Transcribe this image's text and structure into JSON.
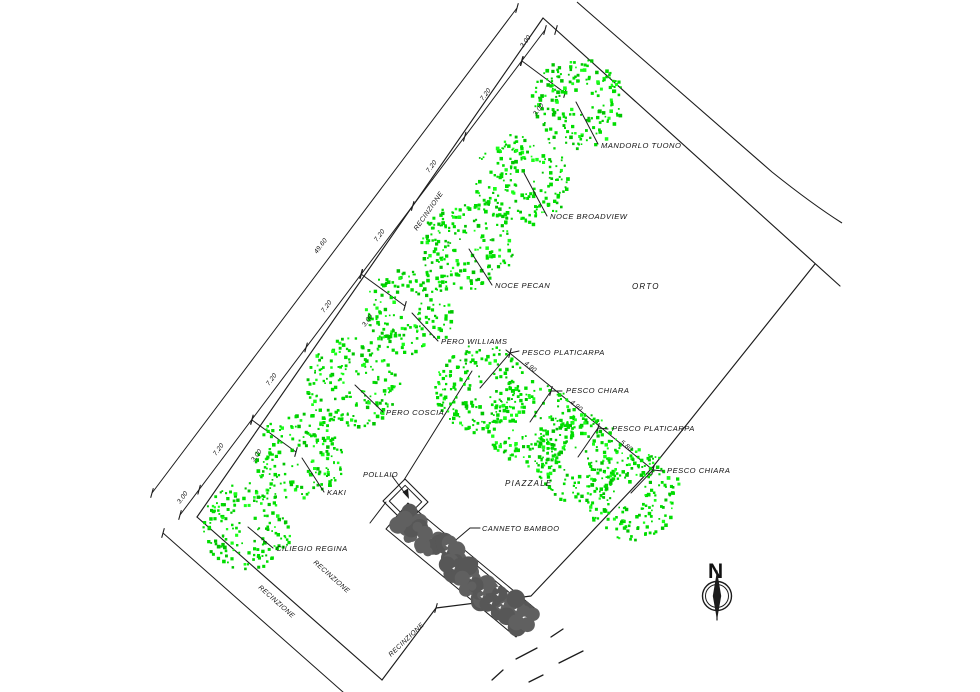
{
  "colors": {
    "line": "#1c1c1c",
    "tree_green": "#00dd00",
    "tree_green_alt": "#00c400",
    "tree_green_bright": "#1aff1a",
    "bamboo_gray": "#606060",
    "background": "#ffffff"
  },
  "plot": {
    "areas": [
      {
        "label": "ORTO",
        "x": 632,
        "y": 289
      },
      {
        "label": "PIAZZALE",
        "x": 505,
        "y": 486
      }
    ],
    "trees": [
      {
        "label": "MANDORLO TUONO",
        "cx": 576,
        "cy": 102,
        "r": 47,
        "leader": [
          576,
          102,
          598,
          144
        ],
        "lx": 601,
        "ly": 148
      },
      {
        "label": "NOCE BROADVIEW",
        "cx": 521,
        "cy": 179,
        "r": 48,
        "leader": [
          524,
          173,
          547,
          216
        ],
        "lx": 550,
        "ly": 219
      },
      {
        "label": "NOCE PECAN",
        "cx": 466,
        "cy": 246,
        "r": 47,
        "leader": [
          469,
          249,
          492,
          285
        ],
        "lx": 495,
        "ly": 288
      },
      {
        "label": "PERO WILLIAMS",
        "cx": 409,
        "cy": 310,
        "r": 45,
        "leader": [
          412,
          313,
          438,
          341
        ],
        "lx": 441,
        "ly": 344
      },
      {
        "label": "PERO COSCIA",
        "cx": 352,
        "cy": 382,
        "r": 47,
        "leader": [
          355,
          385,
          383,
          412
        ],
        "lx": 386,
        "ly": 415
      },
      {
        "label": "KAKI",
        "cx": 299,
        "cy": 455,
        "r": 45,
        "leader": [
          302,
          458,
          324,
          492
        ],
        "lx": 327,
        "ly": 495
      },
      {
        "label": "CILIEGIO REGINA",
        "cx": 246,
        "cy": 525,
        "r": 45,
        "leader": [
          248,
          527,
          273,
          548
        ],
        "lx": 276,
        "ly": 551
      },
      {
        "label": "PESCO PLATICARPA",
        "cx": 480,
        "cy": 388,
        "r": 46,
        "leader": [
          480,
          388,
          510,
          353
        ],
        "lx": 522,
        "ly": 355,
        "tick_leader": [
          510,
          353,
          519,
          351
        ]
      },
      {
        "label": "PESCO CHIARA",
        "cx": 530,
        "cy": 422,
        "r": 45,
        "leader": [
          530,
          422,
          551,
          391
        ],
        "lx": 566,
        "ly": 393,
        "tick_leader": [
          551,
          391,
          562,
          391
        ]
      },
      {
        "label": "PESCO PLATICARPA",
        "cx": 578,
        "cy": 457,
        "r": 46,
        "leader": [
          578,
          457,
          598,
          428
        ],
        "lx": 612,
        "ly": 431,
        "tick_leader": [
          598,
          428,
          608,
          429
        ]
      },
      {
        "label": "PESCO CHIARA",
        "cx": 631,
        "cy": 493,
        "r": 48,
        "leader": [
          631,
          493,
          653,
          470
        ],
        "lx": 667,
        "ly": 473,
        "tick_leader": [
          653,
          470,
          663,
          471
        ]
      }
    ],
    "lines": [
      {
        "name": "ne-fence",
        "pts": [
          [
            543,
            18
          ],
          [
            840,
            286
          ]
        ]
      },
      {
        "name": "nw-fence",
        "pts": [
          [
            543,
            18
          ],
          [
            197,
            517
          ]
        ]
      },
      {
        "name": "sw-fence",
        "pts": [
          [
            197,
            517
          ],
          [
            382,
            680
          ]
        ]
      },
      {
        "name": "se-fence",
        "pts": [
          [
            382,
            680
          ],
          [
            436,
            608
          ],
          [
            531,
            596
          ],
          [
            652,
            468
          ],
          [
            815,
            264
          ]
        ]
      },
      {
        "name": "dim-chain-inner",
        "pts": [
          [
            545,
            30
          ],
          [
            180,
            515
          ]
        ]
      },
      {
        "name": "dim-chain-outer",
        "pts": [
          [
            517,
            8
          ],
          [
            152,
            493
          ]
        ]
      },
      {
        "name": "dim-line-southwest",
        "pts": [
          [
            163,
            533
          ],
          [
            352,
            700
          ]
        ]
      },
      {
        "name": "offset-stub-pero",
        "pts": [
          [
            361,
            274
          ],
          [
            405,
            306
          ]
        ]
      },
      {
        "name": "offset-stub-kaki",
        "pts": [
          [
            252,
            420
          ],
          [
            296,
            452
          ]
        ]
      },
      {
        "name": "offset-stub-mandorlo",
        "pts": [
          [
            522,
            61
          ],
          [
            565,
            93
          ]
        ]
      },
      {
        "name": "internal-line",
        "pts": [
          [
            472,
            371
          ],
          [
            404,
            480
          ]
        ]
      },
      {
        "name": "internal-line-b",
        "pts": [
          [
            386,
            502
          ],
          [
            370,
            523
          ]
        ]
      },
      {
        "name": "pesco-chain",
        "pts": [
          [
            506,
            350
          ],
          [
            653,
            470
          ]
        ]
      },
      {
        "name": "canneto-leader",
        "pts": [
          [
            480,
            528
          ],
          [
            470,
            528
          ],
          [
            450,
            545
          ]
        ]
      },
      {
        "name": "bamboo-inner-edge",
        "pts": [
          [
            470,
            560
          ],
          [
            534,
            613
          ]
        ]
      }
    ],
    "road_path": "M577,2 L772,172 Q812,204 842,223",
    "ticks": [
      [
        545,
        30
      ],
      [
        521.6,
        61.1
      ],
      [
        464.7,
        136.7
      ],
      [
        412.7,
        205.9
      ],
      [
        361.4,
        273.9
      ],
      [
        306.1,
        347.4
      ],
      [
        251.9,
        419.5
      ],
      [
        199.1,
        489.7
      ],
      [
        180,
        515
      ],
      [
        517,
        8
      ],
      [
        152,
        493
      ],
      [
        163,
        533
      ],
      [
        352,
        700
      ],
      [
        522,
        61
      ],
      [
        565,
        93
      ],
      [
        361,
        274
      ],
      [
        405,
        306
      ],
      [
        252,
        420
      ],
      [
        296,
        452
      ],
      [
        556,
        30
      ],
      [
        436,
        608
      ],
      [
        510,
        353
      ],
      [
        551,
        391
      ],
      [
        598,
        428
      ],
      [
        653,
        470
      ]
    ],
    "dim_labels": [
      {
        "t": "3.00",
        "x": 523,
        "y": 48,
        "r": -53
      },
      {
        "t": "7.20",
        "x": 483,
        "y": 101,
        "r": -53
      },
      {
        "t": "7.20",
        "x": 429,
        "y": 173,
        "r": -53
      },
      {
        "t": "7.20",
        "x": 377,
        "y": 242,
        "r": -53
      },
      {
        "t": "7.20",
        "x": 324,
        "y": 313,
        "r": -53
      },
      {
        "t": "7.20",
        "x": 269,
        "y": 386,
        "r": -53
      },
      {
        "t": "7.20",
        "x": 216,
        "y": 456,
        "r": -53
      },
      {
        "t": "3.00",
        "x": 180,
        "y": 504,
        "r": -53
      },
      {
        "t": "49.60",
        "x": 317,
        "y": 254,
        "r": -53
      },
      {
        "t": "3.00",
        "x": 536,
        "y": 116,
        "r": -53
      },
      {
        "t": "3.00",
        "x": 365,
        "y": 327,
        "r": -53
      },
      {
        "t": "3.00",
        "x": 254,
        "y": 462,
        "r": -53
      },
      {
        "t": "4.90",
        "x": 524,
        "y": 364,
        "r": 39
      },
      {
        "t": "4.90",
        "x": 570,
        "y": 403,
        "r": 39
      },
      {
        "t": "5.80",
        "x": 620,
        "y": 443,
        "r": 39
      }
    ],
    "fence_labels": [
      {
        "t": "RECINZIONE",
        "x": 417,
        "y": 231,
        "r": -55
      },
      {
        "t": "RECINZIONE",
        "x": 258,
        "y": 588,
        "r": 41.5
      },
      {
        "t": "RECINZIONE",
        "x": 313,
        "y": 563,
        "r": 41.5
      },
      {
        "t": "RECINZIONE",
        "x": 391,
        "y": 657,
        "r": -43.5
      }
    ],
    "pollaio": {
      "label": "POLLAIO",
      "label_x": 363,
      "label_y": 477,
      "outer": [
        [
          405,
          479
        ],
        [
          428,
          502
        ],
        [
          406,
          524
        ],
        [
          383,
          501
        ]
      ],
      "inner": [
        [
          405.1,
          485.3
        ],
        [
          421.7,
          501.9
        ],
        [
          405.9,
          517.7
        ],
        [
          389.3,
          501.1
        ]
      ],
      "arrow_line": [
        [
          392,
          476
        ],
        [
          407,
          496
        ]
      ],
      "arrow_head": [
        [
          409,
          499
        ],
        [
          402.5,
          492
        ],
        [
          408,
          488.5
        ]
      ]
    },
    "bamboo": {
      "label": "CANNETO BAMBOO",
      "label_x": 482,
      "label_y": 531,
      "outline": [
        [
          408,
          503
        ],
        [
          538,
          611
        ],
        [
          516,
          637
        ],
        [
          386,
          529
        ]
      ],
      "axis": [
        [
          397,
          516
        ],
        [
          527,
          624
        ]
      ]
    },
    "dashes": [
      [
        551,
        637,
        563,
        629
      ],
      [
        516,
        659,
        537,
        648
      ],
      [
        559,
        663,
        583,
        651
      ],
      [
        492,
        680,
        503,
        670
      ],
      [
        529,
        682,
        543,
        675
      ]
    ],
    "north": {
      "label": "N",
      "lx": 708,
      "ly": 578,
      "cx": 717,
      "cy": 596,
      "r_outer": 14.5,
      "r_inner": 11.5,
      "top": 571,
      "bottom": 620,
      "hw": 4.2
    }
  }
}
